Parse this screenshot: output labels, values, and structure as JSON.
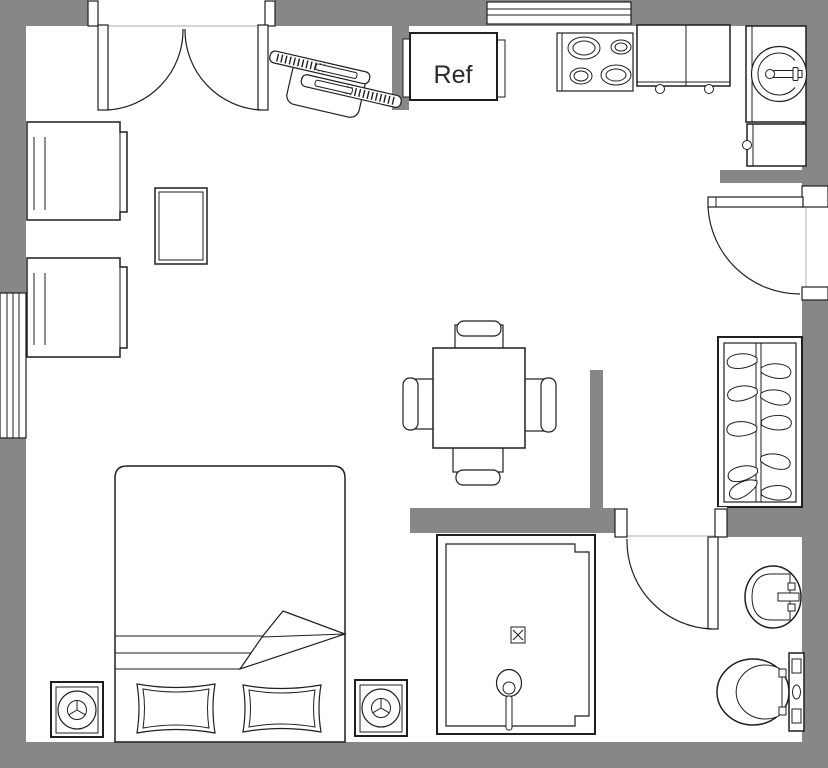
{
  "floorplan": {
    "refrigerator_label": "Ref",
    "colors": {
      "wall": "#878787",
      "line": "#1f1f1f",
      "floor": "#ffffff",
      "threshold": "#c9c9c9"
    },
    "symbols": [
      "double-entry-door",
      "window",
      "tv-console",
      "refrigerator",
      "stove",
      "kitchen-cabinet",
      "kitchen-sink",
      "base-cabinet",
      "entry-door",
      "armchair",
      "side-table",
      "dining-table",
      "dining-chair",
      "wardrobe-closet",
      "clothes-hanger",
      "bed",
      "blanket-fold",
      "pillow",
      "speaker",
      "shower-enclosure",
      "shower-drain",
      "shower-head",
      "bathroom-door",
      "bathroom-sink",
      "toilet"
    ]
  }
}
